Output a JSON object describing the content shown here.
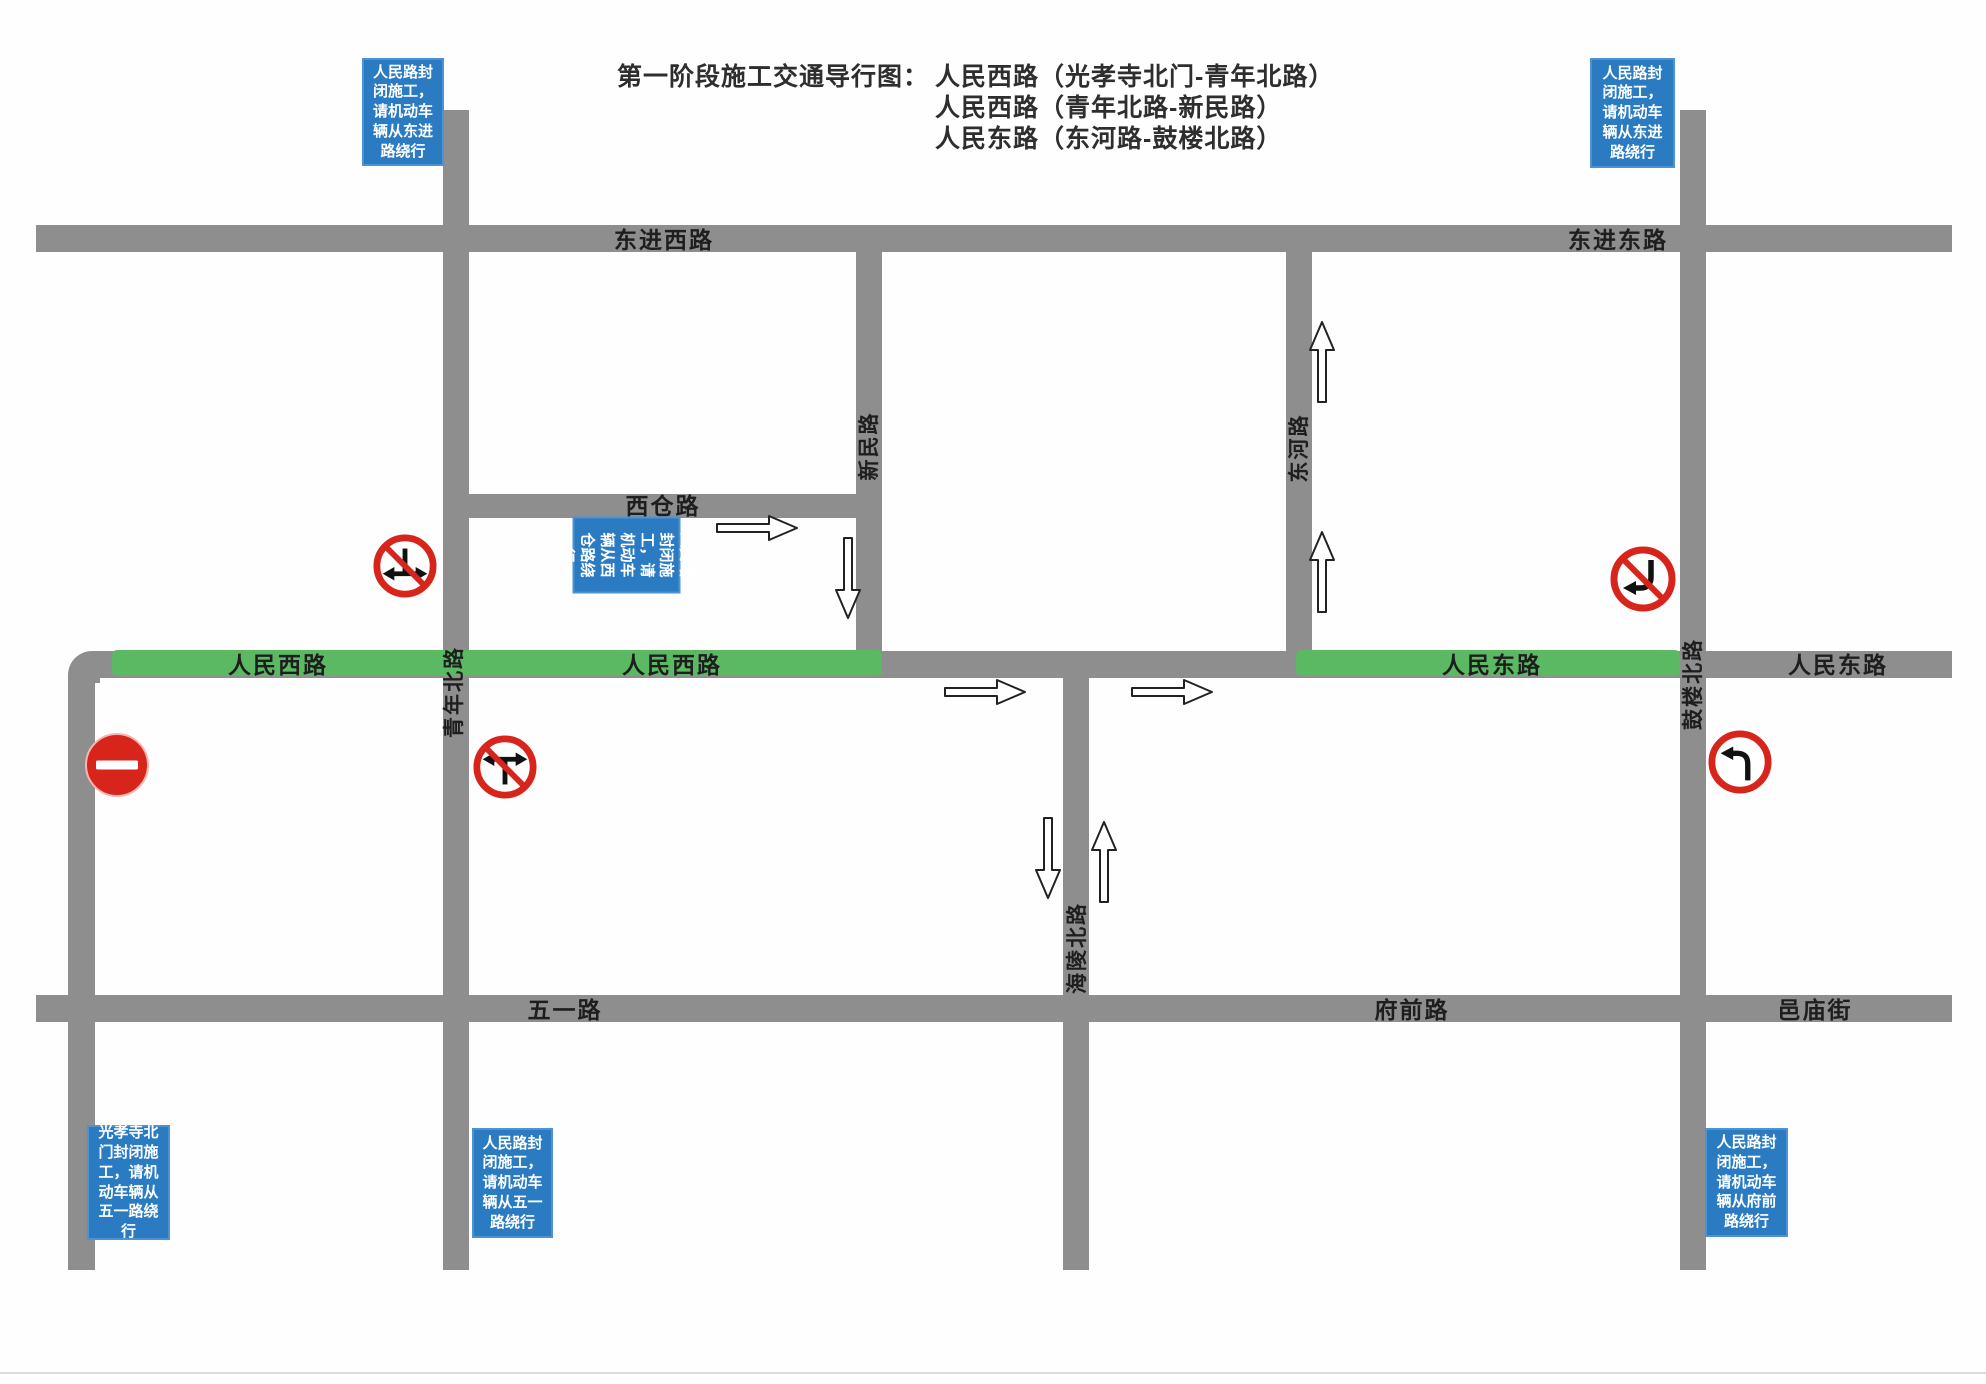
{
  "title": {
    "label": "第一阶段施工交通导行图：",
    "routes": [
      "人民西路（光孝寺北门-青年北路）",
      "人民西路（青年北路-新民路）",
      "人民东路（东河路-鼓楼北路）"
    ]
  },
  "notices": {
    "top_left": "人民路封闭施工，请机动车辆从东进路绕行",
    "top_right": "人民路封闭施工，请机动车辆从东进路绕行",
    "xicang": "人民路封闭施工，请机动车辆从西仓路绕行",
    "bottom_left": "光孝寺北门封闭施工，请机动车辆从五一路绕行",
    "bottom_mid": "人民路封闭施工，请机动车辆从五一路绕行",
    "bottom_right": "人民路封闭施工，请机动车辆从府前路绕行"
  },
  "roads": {
    "dongjin_west": "东进西路",
    "dongjin_east": "东进东路",
    "xicang": "西仓路",
    "renmin_west_a": "人民西路",
    "renmin_west_b": "人民西路",
    "renmin_east_a": "人民东路",
    "renmin_east_b": "人民东路",
    "wuyi": "五一路",
    "fuqian": "府前路",
    "yimiao": "邑庙街",
    "qingnian_bei": "青年北路",
    "xinmin": "新民路",
    "donghe": "东河路",
    "hailing_bei": "海陵北路",
    "gulou_bei": "鼓楼北路"
  },
  "signs": {
    "no_entry": "no-entry-sign",
    "no_left_right_turn_from_north": "no-left-right-turn-sign",
    "no_left_right_turn_from_south": "no-left-right-turn-sign",
    "no_left_turn_slashed": "no-left-turn-sign",
    "left_turn": "left-turn-sign"
  },
  "colors": {
    "road": "#8E8E8E",
    "closed_segment_green": "#5BB964",
    "notice_blue": "#2B7BC2",
    "sign_red": "#D8251C"
  }
}
